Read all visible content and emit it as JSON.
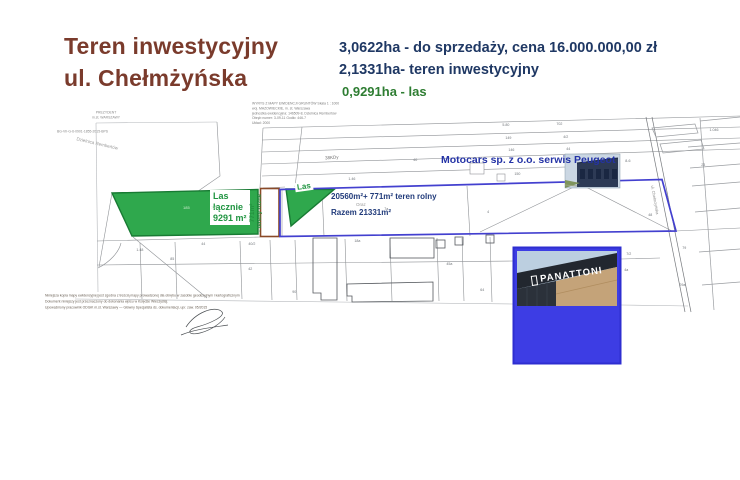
{
  "title": {
    "line1": "Teren inwestycyjny",
    "line2": "ul. Chełmżyńska"
  },
  "stats": {
    "line1": "3,0622ha - do sprzedaży, cena 16.000.000,00 zł",
    "line2": "2,1331ha- teren inwestycyjny",
    "line3": "0,9291ha - las"
  },
  "colors": {
    "title_brown": "#7a3b2c",
    "stats_navy": "#1f3864",
    "stats_green": "#2e7d32",
    "forest_fill": "#2fa84d",
    "forest_stroke": "#187a33",
    "boundary_blue": "#4340cf",
    "strip_brown": "#8a4a28",
    "panattoni_blue": "#3d3de4",
    "motocars_text": "#2433a6",
    "forest_label_green": "#1f9440"
  },
  "map": {
    "header_left": [
      "PREZYDENT",
      "m.st. WARSZAWY"
    ],
    "header_right": [
      "WYRYS Z MAPY EWIDENCJI GRUNTÓW Skala 1 : 1000",
      "woj. MAZOWIECKIE,  m. st. Warszawa",
      "jednostka ewidencyjna: 146509-8, Dzielnica Rembertów",
      "Obręb numer: 3-09-11   Godło: 446-7",
      "Układ: 2000"
    ],
    "header_ref": "BG-VII-G-6-0901-1855-2015-BPS",
    "district_label": "Dzielnica Rembertów",
    "street_label": "38KDy",
    "road_label": "ul. Chełmżyńska",
    "forest_box": [
      "Las",
      "łącznie",
      "9291 m²"
    ],
    "forest_small": "Las",
    "strip_label": [
      "771m²",
      "- tereny różne"
    ],
    "area_line1": "20560m²+ 771m² teren rolny",
    "area_mid": "Oraz",
    "area_line2": "Razem 21331m²",
    "motocars": "Motocars sp. z o.o. serwis Peugeot",
    "green_parcels": [
      {
        "t": "185",
        "x": 183,
        "y": 205
      },
      {
        "t": "7/8",
        "x": 211,
        "y": 205
      }
    ],
    "tiny": [
      {
        "t": "5.80",
        "x": 502,
        "y": 122
      },
      {
        "t": "702",
        "x": 556,
        "y": 121
      },
      {
        "t": "149",
        "x": 505,
        "y": 135
      },
      {
        "t": "4/2",
        "x": 563,
        "y": 134
      },
      {
        "t": "146",
        "x": 508,
        "y": 147
      },
      {
        "t": "44",
        "x": 566,
        "y": 146
      },
      {
        "t": "150",
        "x": 514,
        "y": 171
      },
      {
        "t": "40",
        "x": 413,
        "y": 157
      },
      {
        "t": "1.46",
        "x": 348,
        "y": 176
      },
      {
        "t": "7a",
        "x": 384,
        "y": 206
      },
      {
        "t": "4",
        "x": 487,
        "y": 209
      },
      {
        "t": "48",
        "x": 648,
        "y": 212
      },
      {
        "t": "8-6",
        "x": 625,
        "y": 158
      },
      {
        "t": "1.046",
        "x": 709,
        "y": 127
      },
      {
        "t": "23",
        "x": 701,
        "y": 162
      },
      {
        "t": "7/2",
        "x": 626,
        "y": 251
      },
      {
        "t": "4a",
        "x": 624,
        "y": 267
      },
      {
        "t": "64",
        "x": 480,
        "y": 287
      },
      {
        "t": "90",
        "x": 292,
        "y": 289
      },
      {
        "t": "1.48",
        "x": 136,
        "y": 247
      },
      {
        "t": "85",
        "x": 170,
        "y": 256
      },
      {
        "t": "40/2",
        "x": 248,
        "y": 241
      },
      {
        "t": "42",
        "x": 248,
        "y": 266
      },
      {
        "t": "44",
        "x": 201,
        "y": 241
      },
      {
        "t": "45a",
        "x": 446,
        "y": 261
      },
      {
        "t": "79",
        "x": 682,
        "y": 245
      },
      {
        "t": "29a",
        "x": 679,
        "y": 282
      },
      {
        "t": "18a",
        "x": 354,
        "y": 238
      }
    ],
    "footer_lines": [
      "Niniejsza kopia mapy ewidencyjnej jest zgodna z treścią mapy prowadzonej dla obrębu w zasobie geodezyjnym i kartograficznym",
      "Dokument niniejszy jest przeznaczony do dokonania wpisu w Księdze Wieczystej.",
      "Upoważniony pracownik ODGiK m.st. Warszawy — Główny Specjalista ds. dokumentacji, upr. zaw. 05/2015"
    ]
  },
  "panattoni": {
    "label": "PANATTONI"
  }
}
